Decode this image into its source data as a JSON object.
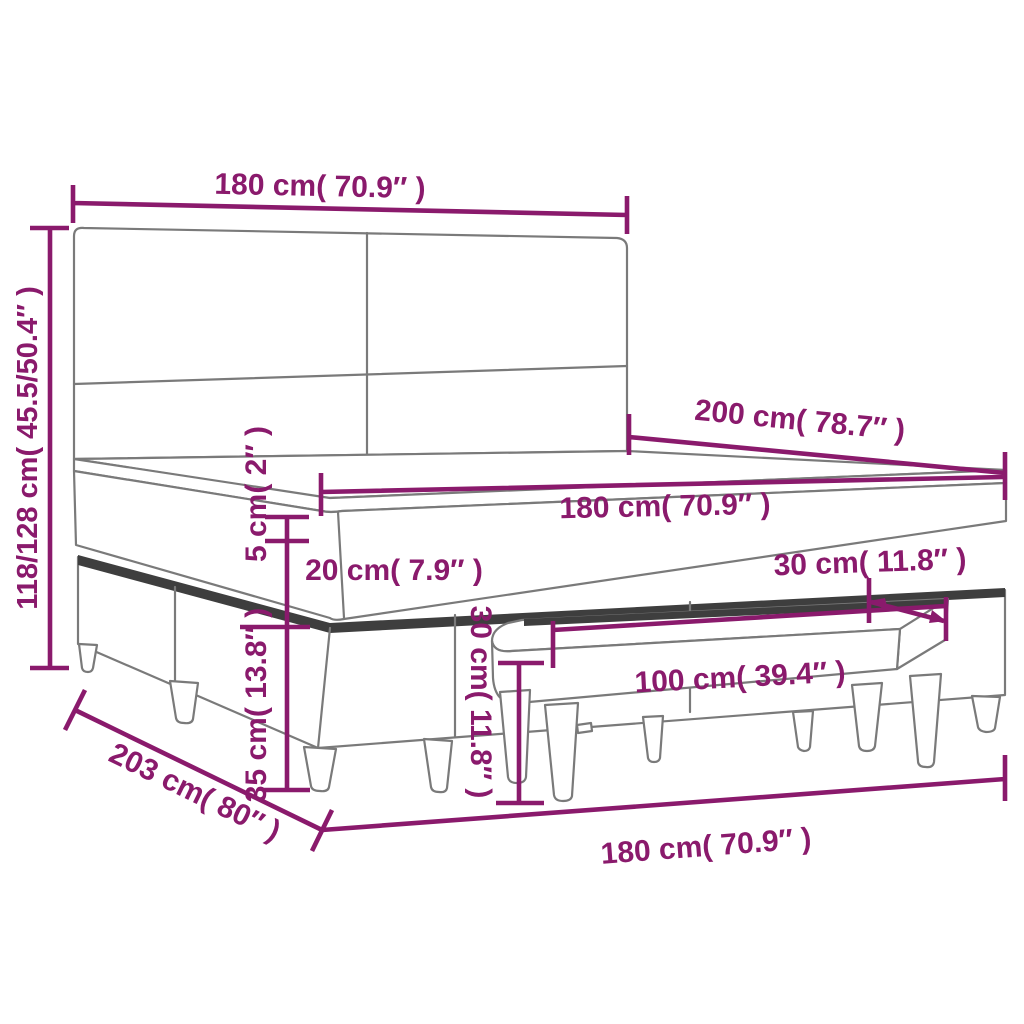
{
  "diagram": {
    "type": "product dimension line drawing",
    "subject": "box spring bed with headboard, mattress topper and bench",
    "colors": {
      "dimension_accent": "#8a1a6c",
      "drawing_outline": "#7a7a7a",
      "edge_shading": "#3e3e3e",
      "background": "#ffffff"
    },
    "labels": {
      "headboard_width_top": "180 cm( 70.9″ )",
      "overall_height": "118/128 cm( 45.5/50.4″ )",
      "bed_length": "200 cm( 78.7″ )",
      "mattress_width": "180 cm( 70.9″ )",
      "topper_thickness": "5 cm( 2″ )",
      "mattress_thickness": "20 cm( 7.9″ )",
      "base_height": "35 cm( 13.8″ )",
      "bench_height": "30 cm( 11.8″ )",
      "bench_depth": "30 cm( 11.8″ )",
      "bench_length": "100 cm( 39.4″ )",
      "frame_length_floor": "203 cm( 80″ )",
      "frame_width_floor": "180 cm( 70.9″ )"
    }
  }
}
